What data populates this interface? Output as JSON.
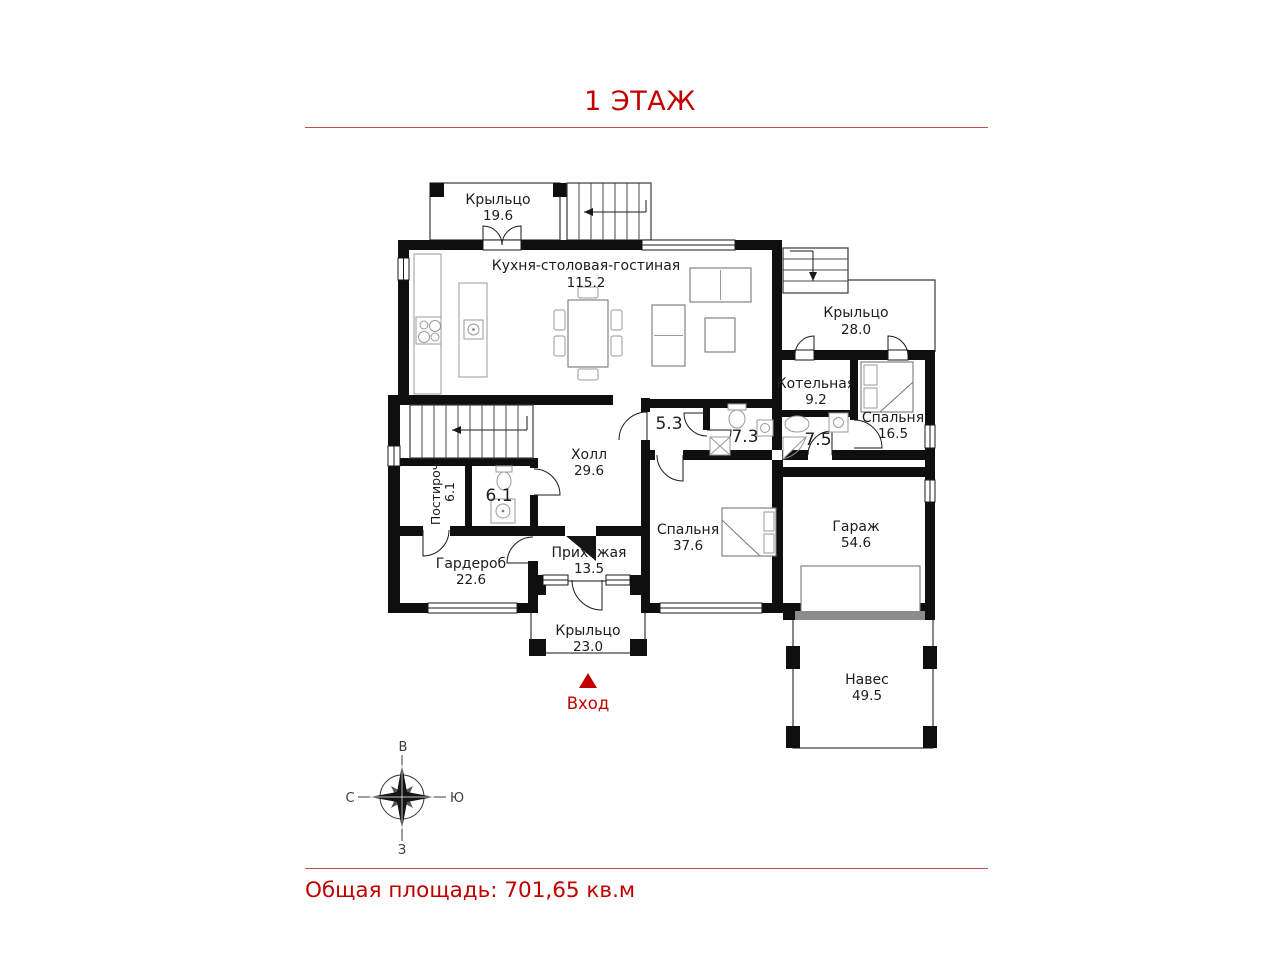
{
  "title": "1 ЭТАЖ",
  "footer": {
    "total_area_label": "Общая площадь: 701,65 кв.м"
  },
  "entrance": {
    "label": "Вход"
  },
  "compass": {
    "top": "В",
    "left": "С",
    "right": "Ю",
    "bottom": "З"
  },
  "colors": {
    "accent_red": "#c00000",
    "wall": "#0f0f0f",
    "gate_gray": "#8c8c8c"
  },
  "rooms": [
    {
      "id": "kitchen",
      "name": "Кухня-столовая-гостиная",
      "area": "115.2"
    },
    {
      "id": "porch_top",
      "name": "Крыльцо",
      "area": "19.6"
    },
    {
      "id": "porch_right",
      "name": "Крыльцо",
      "area": "28.0"
    },
    {
      "id": "boiler",
      "name": "Котельная",
      "area": "9.2"
    },
    {
      "id": "bedroom_small",
      "name": "Спальня",
      "area": "16.5"
    },
    {
      "id": "bath_75",
      "name": "",
      "area": "7.5"
    },
    {
      "id": "bath_73",
      "name": "",
      "area": "7.3"
    },
    {
      "id": "store_53",
      "name": "",
      "area": "5.3"
    },
    {
      "id": "hall",
      "name": "Холл",
      "area": "29.6"
    },
    {
      "id": "laundry",
      "name": "Постироч.",
      "area": "6.1"
    },
    {
      "id": "wc",
      "name": "",
      "area": "6.1"
    },
    {
      "id": "wardrobe",
      "name": "Гардероб",
      "area": "22.6"
    },
    {
      "id": "entry_hall",
      "name": "Прихожая",
      "area": "13.5"
    },
    {
      "id": "bedroom_big",
      "name": "Спальня",
      "area": "37.6"
    },
    {
      "id": "garage",
      "name": "Гараж",
      "area": "54.6"
    },
    {
      "id": "porch_bottom",
      "name": "Крыльцо",
      "area": "23.0"
    },
    {
      "id": "canopy",
      "name": "Навес",
      "area": "49.5"
    }
  ]
}
